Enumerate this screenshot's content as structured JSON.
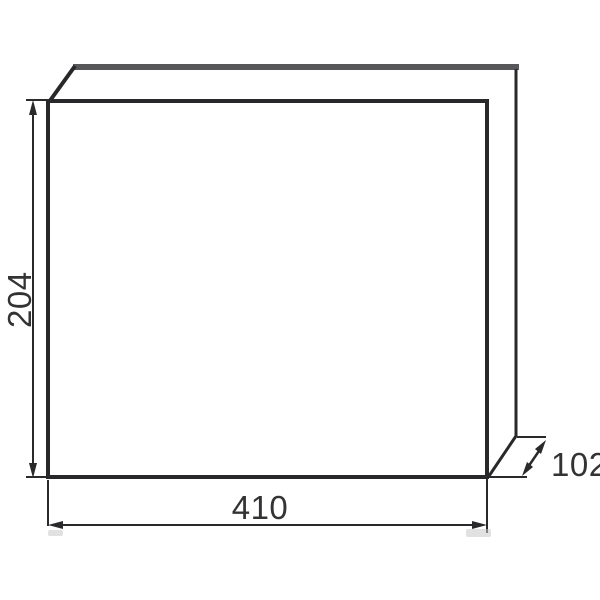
{
  "labels": {
    "height": "204",
    "width": "410",
    "depth": "102"
  },
  "colors": {
    "outline": "#28282a",
    "lid_edge": "#57575a",
    "dimension_line": "#2a2a2c",
    "label_text": "#333335",
    "background": "#ffffff"
  }
}
